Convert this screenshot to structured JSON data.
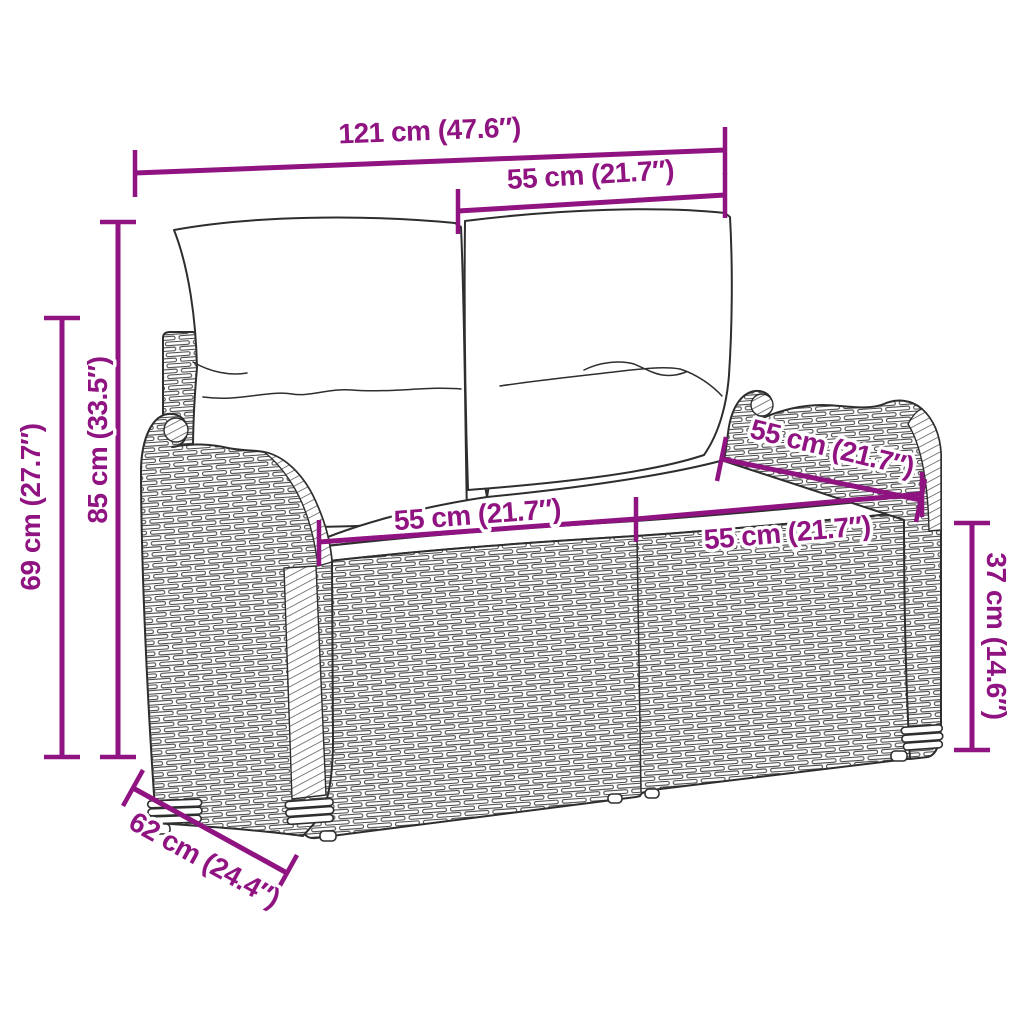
{
  "colors": {
    "annotation": "#8F1380",
    "line_art": "#2E2E2E",
    "background": "#FFFFFF"
  },
  "annotations": {
    "overall_width": {
      "label": "121 cm (47.6″)",
      "cm": 121,
      "inches": 47.6
    },
    "backrest_cushion_width": {
      "label": "55 cm (21.7″)",
      "cm": 55,
      "inches": 21.7
    },
    "total_height": {
      "label": "85 cm (33.5″)",
      "cm": 85,
      "inches": 33.5
    },
    "armrest_height": {
      "label": "69 cm (27.7″)",
      "cm": 69,
      "inches": 27.7
    },
    "seat_width_left": {
      "label": "55 cm (21.7″)",
      "cm": 55,
      "inches": 21.7
    },
    "seat_width_right": {
      "label": "55 cm (21.7″)",
      "cm": 55,
      "inches": 21.7
    },
    "seat_depth": {
      "label": "55 cm (21.7″)",
      "cm": 55,
      "inches": 21.7
    },
    "seat_height": {
      "label": "37 cm (14.6″)",
      "cm": 37,
      "inches": 14.6
    },
    "base_depth": {
      "label": "62 cm (24.4″)",
      "cm": 62,
      "inches": 24.4
    }
  }
}
